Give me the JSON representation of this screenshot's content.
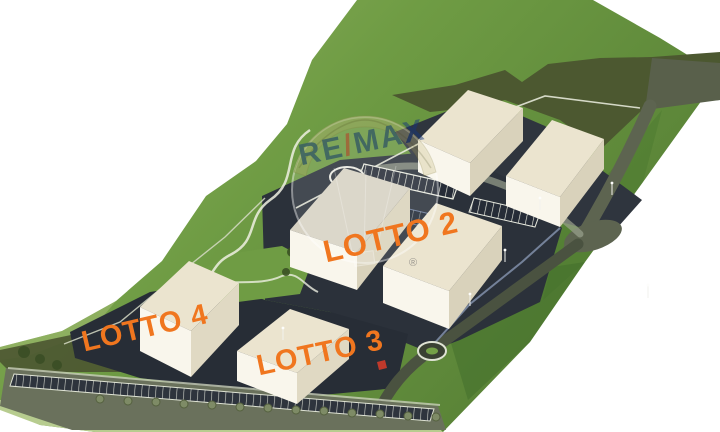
{
  "scene": {
    "description": "3D aerial rendering of an industrial development site with six warehouse buildings on a green hillside",
    "background": "#ffffff",
    "grass_light": "#93b263",
    "grass_mid": "#6f9c44",
    "grass_dark": "#567f35",
    "olive_band": "#4c5830",
    "asphalt": "#2b313a",
    "road_gray": "#5d6450",
    "building_roof": "#ebe4cf",
    "building_front": "#f9f6ec",
    "building_side": "#d9d2bb",
    "bottom_grass": "#b7cc8f",
    "buildings_count": 6
  },
  "labels": {
    "color": "#f0761f",
    "lot2": "LOTTO 2",
    "lot3": "LOTTO 3",
    "lot4": "LOTTO 4"
  },
  "watermark": {
    "brand": "RE/MAX",
    "re": "RE",
    "slash": "/",
    "max": "MAX",
    "registered": "®",
    "color_blue": "#16367c",
    "color_red": "#cc3a31"
  }
}
